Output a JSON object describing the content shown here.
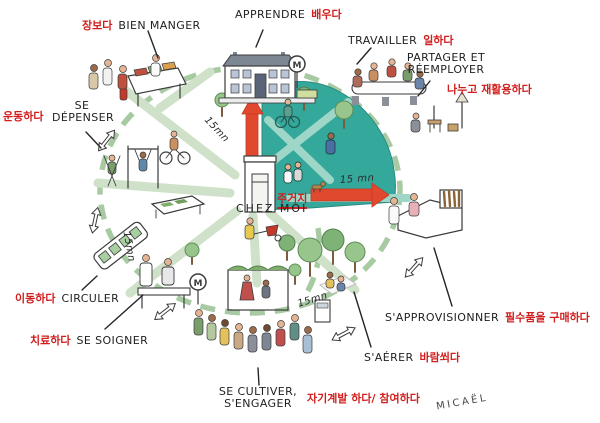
{
  "colors": {
    "teal_zone": "#34a89a",
    "path_green": "#a3c79e",
    "road_green": "#cfe2c9",
    "arrow_red": "#e0492e",
    "korean_red": "#d11f1f",
    "french_black": "#1f1f1f"
  },
  "scene": {
    "metro_letter": "M",
    "signature": "MICAËL"
  },
  "center_label": {
    "fr": "CHEZ MOI",
    "ko": "주거지"
  },
  "travel_times": {
    "top_left": "15mn",
    "left": "15mn",
    "right_arrow": "15 mn",
    "bottom": "15mn"
  },
  "activities": {
    "bien_manger": {
      "fr": "BIEN MANGER",
      "ko": "장보다"
    },
    "apprendre": {
      "fr": "APPRENDRE",
      "ko": "배우다"
    },
    "travailler": {
      "fr": "TRAVAILLER",
      "ko": "일하다"
    },
    "partager_reemployer": {
      "fr_line1": "PARTAGER ET",
      "fr_line2": "RÉEMPLOYER",
      "ko": "나누고 재활용하다"
    },
    "se_depenser": {
      "fr_line1": "SE",
      "fr_line2": "DÉPENSER",
      "ko": "운동하다"
    },
    "circuler": {
      "fr": "CIRCULER",
      "ko": "이동하다"
    },
    "se_soigner": {
      "fr": "SE SOIGNER",
      "ko": "치료하다"
    },
    "se_cultiver_sengager": {
      "fr_line1": "SE CULTIVER,",
      "fr_line2": "S'ENGAGER",
      "ko": "자기계발 하다/ 참여하다"
    },
    "s_aerer": {
      "fr": "S'AÉRER",
      "ko": "바람쐬다"
    },
    "s_approvisionner": {
      "fr": "S'APPROVISIONNER",
      "ko": "필수품을 구매하다"
    }
  }
}
